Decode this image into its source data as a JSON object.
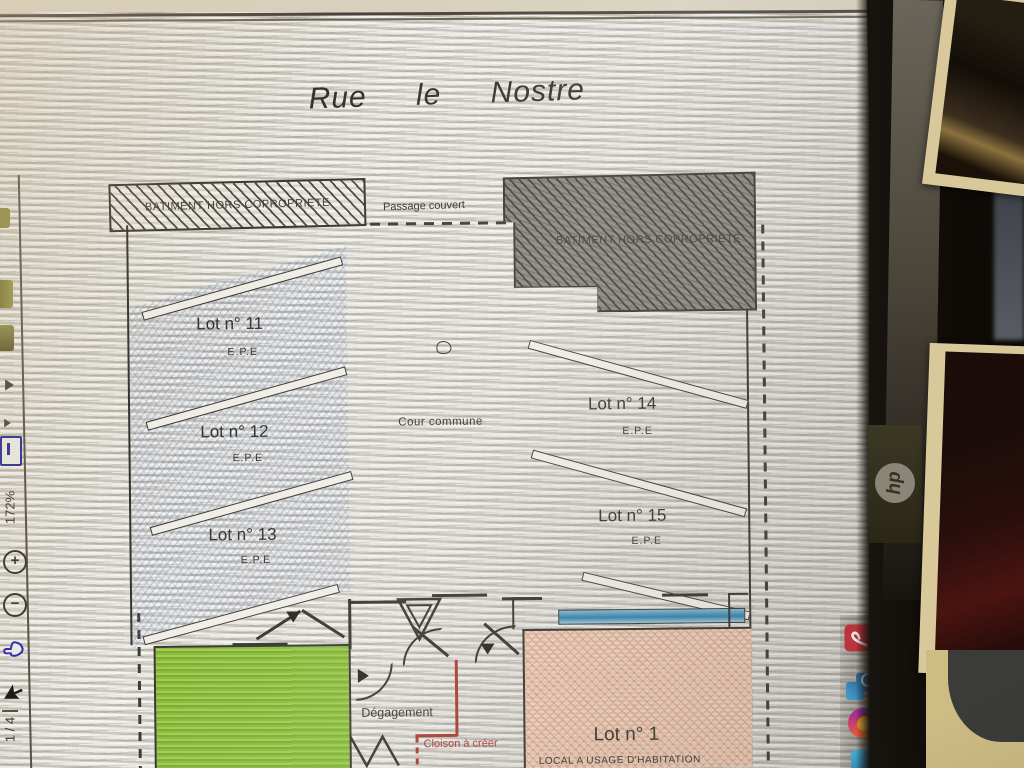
{
  "plan": {
    "title": "Rue le Nostre",
    "building_left_label": "BATIMENT HORS COPROPRIETE",
    "building_right_label": "BATIMENT HORS COPROPRIETE",
    "passage_label": "Passage couvert",
    "courtyard_label": "Cour commune",
    "hallway_label": "Dégagement",
    "partition_label": "Cloison à créer",
    "lots": [
      {
        "name": "Lot n° 11",
        "sub": "E.P.E"
      },
      {
        "name": "Lot n° 12",
        "sub": "E.P.E"
      },
      {
        "name": "Lot n° 13",
        "sub": "E.P.E"
      },
      {
        "name": "Lot n° 14",
        "sub": "E.P.E"
      },
      {
        "name": "Lot n° 15",
        "sub": "E.P.E"
      },
      {
        "name": "Lot n° 1",
        "sub": "LOCAL A USAGE D'HABITATION"
      }
    ]
  },
  "viewer": {
    "zoom_level": "172%",
    "page_indicator": "1 / 4",
    "zoom_in_glyph": "+",
    "zoom_out_glyph": "−"
  },
  "taskbar": {
    "apps": [
      "adobe-acrobat",
      "photos",
      "firefox",
      "edge"
    ]
  },
  "monitor": {
    "brand": "hp"
  },
  "colors": {
    "lot_hatch_blue": "#5f7fc0",
    "green_room": "#8cbd3a",
    "pink_room": "#e7c3ab",
    "window_blue": "#4a9cc2",
    "partition_red": "#a8362a",
    "taskbar_accent": "#71b7e6"
  }
}
